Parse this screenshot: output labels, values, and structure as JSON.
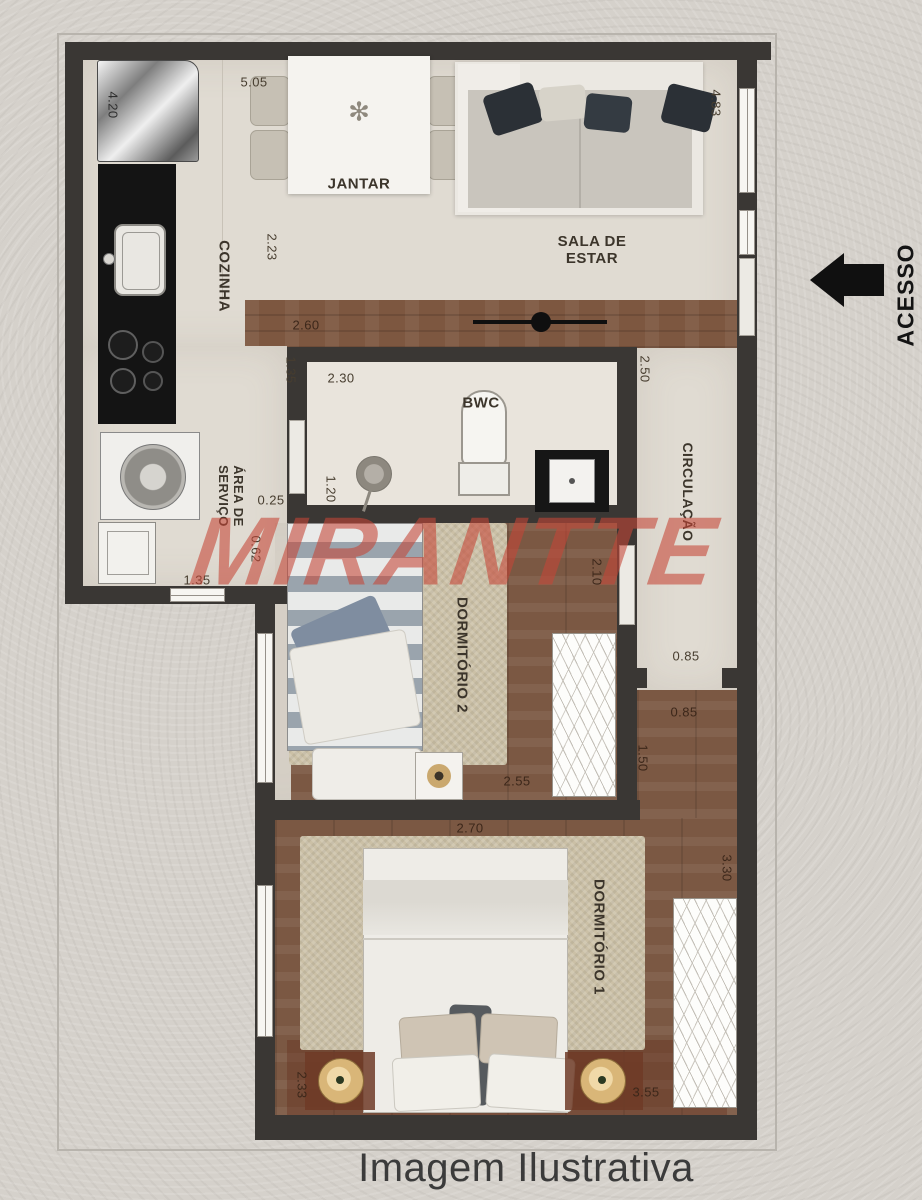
{
  "watermark": "MIRANTTE",
  "caption": "Imagem Ilustrativa",
  "access": {
    "label": "ACESSO"
  },
  "rooms": {
    "cozinha": "COZINHA",
    "jantar": "JANTAR",
    "sala_line1": "SALA DE",
    "sala_line2": "ESTAR",
    "bwc": "BWC",
    "servico_line1": "ÁREA DE",
    "servico_line2": "SERVIÇO",
    "circulacao": "CIRCULAÇÃO",
    "dormitorio2": "DORMITÓRIO 2",
    "dormitorio1": "DORMITÓRIO 1"
  },
  "dimensions": {
    "kitchen_left_height": "4.20",
    "top_width": "5.05",
    "dining_depth": "2.23",
    "living_height": "4.83",
    "hall_width": "2.60",
    "bwc_entry_side": "1.35",
    "bwc_width": "2.30",
    "bwc_right_height": "2.50",
    "bwc_left_height": "1.20",
    "servico_gap": "0.25",
    "servico_depth": "0.62",
    "servico_width": "1.35",
    "circ_upper": "0.85",
    "circ_lower": "0.85",
    "circ_entry": "1.50",
    "dorm2_right_height": "2.10",
    "dorm2_bottom_width": "2.55",
    "dorm1_top_width": "2.70",
    "dorm1_right_height": "3.30",
    "dorm1_left_height": "2.33",
    "dorm1_bottom_width": "3.55"
  },
  "colors": {
    "wall": "#3a3734",
    "floor_light": "#e0dbd2",
    "floor_wood": "#7b5843",
    "rug": "#cbc0a6",
    "watermark": "#c64637",
    "background": "#d5d1cb"
  }
}
